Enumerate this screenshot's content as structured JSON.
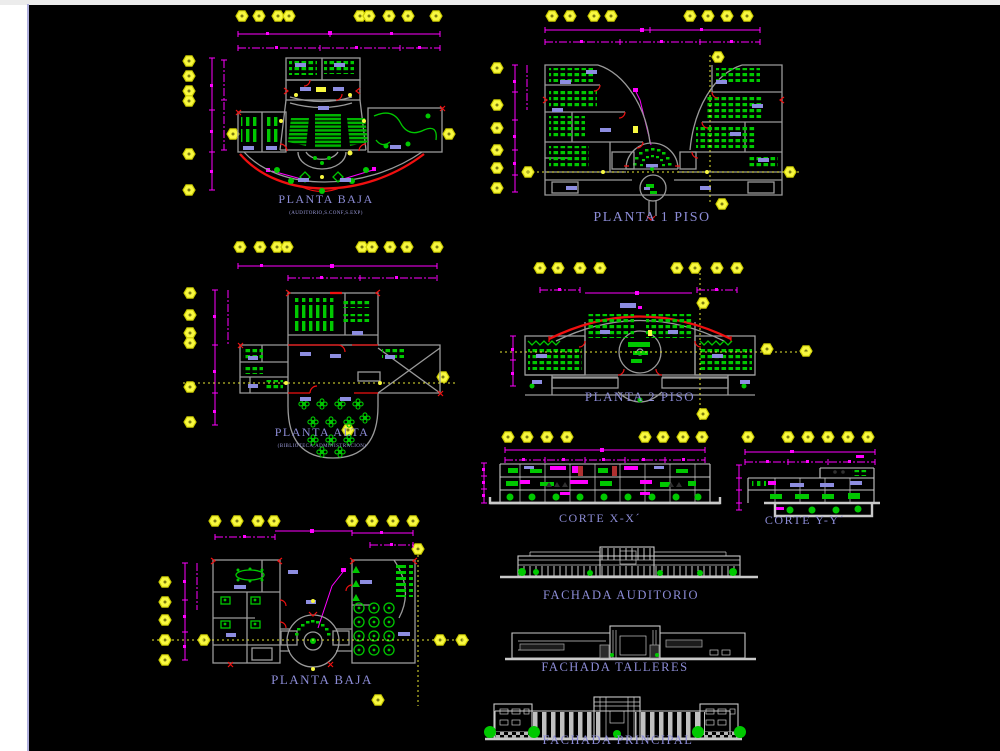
{
  "colors": {
    "background": "#000000",
    "top_strip": "#ececec",
    "page_margin": "#ffffff",
    "page_border": "#b0b0dd",
    "wall_gray": "#9a9a9a",
    "section_gray": "#c9c9c9",
    "dimension_magenta": "#ff00ff",
    "furniture_green": "#00c800",
    "accent_red": "#f01010",
    "grid_bubble_yellow": "#f8f840",
    "fixture_violet": "#8d8de0",
    "label_blue": "#8c8cd6"
  },
  "views": {
    "planta_baja_auditorio": {
      "title": "PLANTA BAJA",
      "subtitle": "(AUDITORIO,S.CONF,S.EXP)"
    },
    "planta_1_piso": {
      "title": "PLANTA 1 PISO"
    },
    "planta_alta": {
      "title": "PLANTA ALTA",
      "subtitle": "(BIBLIOTECA,ADMINISTRACION)"
    },
    "planta_2_piso": {
      "title": "PLANTA 2 PISO"
    },
    "corte_xx": {
      "title": "CORTE X-X´"
    },
    "corte_yy": {
      "title": "CORTE Y-Y´"
    },
    "planta_baja_2": {
      "title": "PLANTA BAJA"
    },
    "fachada_auditorio": {
      "title": "FACHADA AUDITORIO"
    },
    "fachada_talleres": {
      "title": "FACHADA TALLERES"
    },
    "fachada_principal": {
      "title": "FACHADA PRINCIPAL"
    }
  }
}
